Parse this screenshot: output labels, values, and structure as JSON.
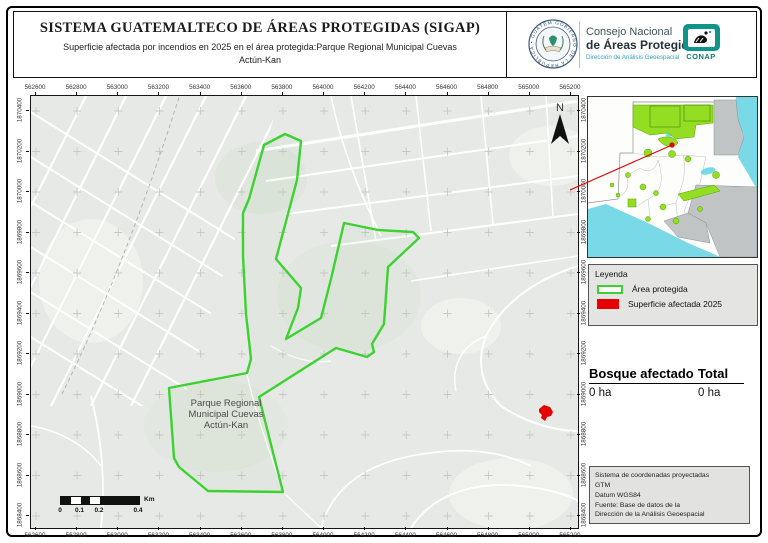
{
  "header": {
    "title": "SISTEMA GUATEMALTECO DE ÁREAS PROTEGIDAS  (SIGAP)",
    "subtitle_lines": [
      "Superficie afectada por incendios en 2025 en el área protegida:Parque Regional Municipal Cuevas",
      "Actún-Kan"
    ],
    "seal_text": "GOBIERNO DE LA REPÚBLICA • GUATEMALA •",
    "org_line1": "Consejo Nacional",
    "org_line2": "de Áreas Protegidas",
    "org_line3": "Dirección de Análisis Geoespacial",
    "conap_label": "CONAP"
  },
  "map": {
    "north_label": "N",
    "park_label_lines": [
      "Parque Regional",
      "Municipal Cuevas",
      "Actún-Kan"
    ],
    "axis_x": [
      "562600",
      "562800",
      "563000",
      "563200",
      "563400",
      "563600",
      "563800",
      "564000",
      "564200",
      "564400",
      "564600",
      "564800",
      "565000",
      "565200"
    ],
    "axis_y": [
      "1870400",
      "1870200",
      "1870000",
      "1869800",
      "1869600",
      "1869400",
      "1869200",
      "1869000",
      "1868800",
      "1868600",
      "1868400"
    ],
    "scale": {
      "labels": [
        "0",
        "0.1",
        "0.2",
        "0.4"
      ],
      "unit": "Km"
    },
    "polygon": [
      [
        254,
        38
      ],
      [
        270,
        45
      ],
      [
        266,
        84
      ],
      [
        245,
        163
      ],
      [
        270,
        192
      ],
      [
        267,
        212
      ],
      [
        255,
        243
      ],
      [
        290,
        222
      ],
      [
        300,
        183
      ],
      [
        313,
        127
      ],
      [
        347,
        134
      ],
      [
        382,
        136
      ],
      [
        388,
        142
      ],
      [
        357,
        171
      ],
      [
        353,
        228
      ],
      [
        341,
        248
      ],
      [
        343,
        256
      ],
      [
        336,
        261
      ],
      [
        305,
        252
      ],
      [
        228,
        301
      ],
      [
        252,
        396
      ],
      [
        177,
        395
      ],
      [
        148,
        371
      ],
      [
        143,
        362
      ],
      [
        138,
        292
      ],
      [
        216,
        277
      ],
      [
        220,
        263
      ],
      [
        215,
        218
      ],
      [
        212,
        160
      ],
      [
        212,
        117
      ],
      [
        218,
        103
      ],
      [
        233,
        49
      ]
    ],
    "burn_spot_map": {
      "x": 513,
      "y": 317
    }
  },
  "legend": {
    "title": "Leyenda",
    "items": [
      {
        "label": "Área protegida",
        "type": "outline",
        "color": "#3cd231"
      },
      {
        "label": "Superficie afectada 2025",
        "type": "fill",
        "color": "#e60000"
      }
    ]
  },
  "stats": {
    "col1_header": "Bosque afectado",
    "col2_header": "Total",
    "col1_value": "0 ha",
    "col2_value": "0 ha"
  },
  "credits": {
    "lines": [
      "Sistema de coordenadas proyectadas",
      "GTM",
      "Datum WGS84",
      "Fuente: Base de datos de la",
      "Dirección de la Análisis Geoespacial"
    ]
  },
  "colors": {
    "protected_green": "#3cd231",
    "burn_red": "#e60000",
    "inset_protected_green": "#93dd23",
    "water_cyan": "#7ad9e7",
    "neighbor_gray": "#c0c4c5",
    "map_background": "#e7e9e6",
    "teal_accent": "#2e9fb8",
    "conap_teal": "#0e9488"
  }
}
